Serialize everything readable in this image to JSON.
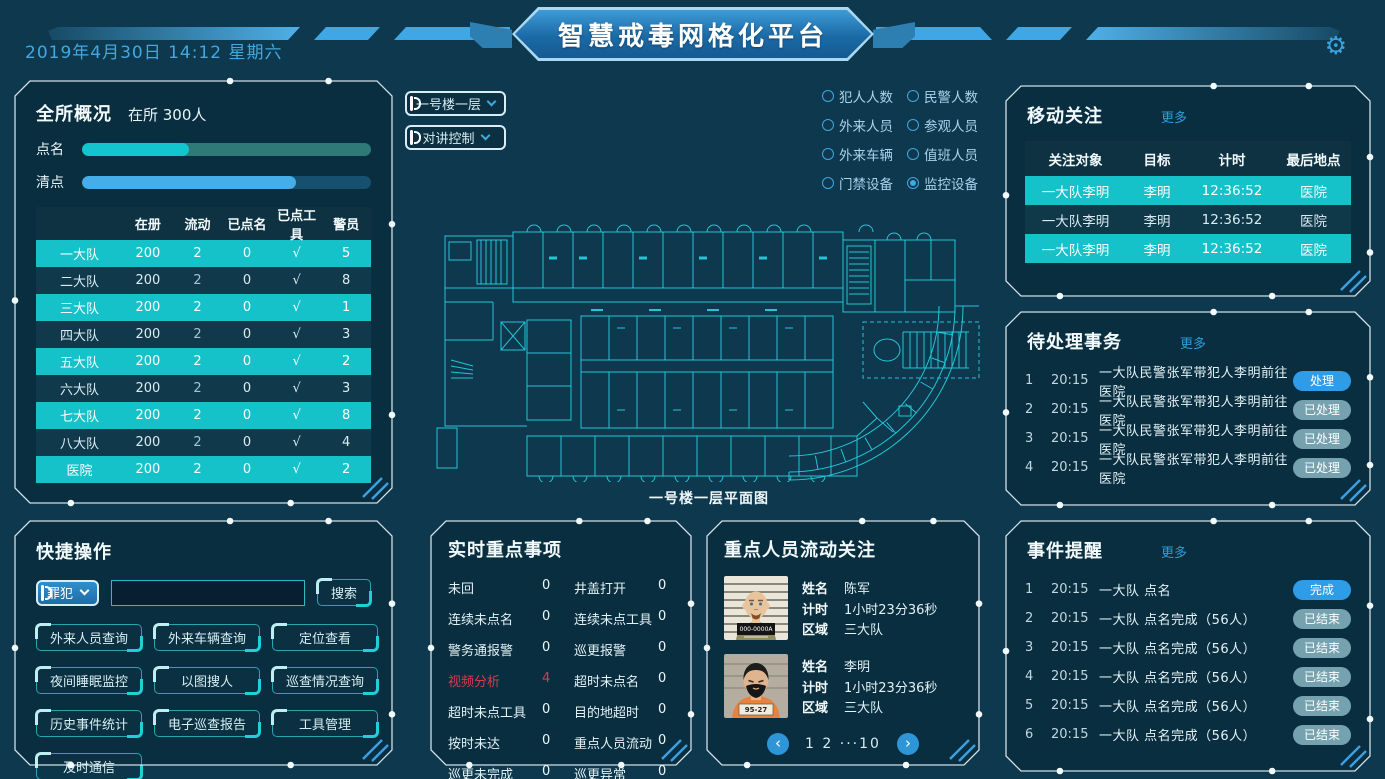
{
  "colors": {
    "background": "#0d384d",
    "panel": "#08283a",
    "accent_blue": "#2f9ce8",
    "accent_cyan": "#15c2ca",
    "row_dark": "#103a4c",
    "bar_rollcall_fill": "#12c5ce",
    "bar_rollcall_track": "#2e7a76",
    "bar_count_fill": "#45aee8",
    "bar_count_track": "#15516e",
    "muted_pill": "#92bfca",
    "alert_red": "#d93a50",
    "floorplan_line": "#23c6d6",
    "link_blue": "#2f9ddb"
  },
  "header": {
    "datetime": "2019年4月30日  14:12  星期六",
    "title": "智慧戒毒网格化平台",
    "settings_icon": "gear-icon",
    "gear_glyph": "⚙"
  },
  "overview": {
    "title": "全所概况",
    "occupancy_label": "在所 300人",
    "bars": [
      {
        "label": "点名",
        "percent": 37
      },
      {
        "label": "清点",
        "percent": 74
      }
    ],
    "table": {
      "headers": [
        "",
        "在册",
        "流动",
        "已点名",
        "已点工具",
        "警员"
      ],
      "rows": [
        {
          "name": "一大队",
          "values": [
            "200",
            "2",
            "0",
            "√",
            "5"
          ],
          "highlight": true
        },
        {
          "name": "二大队",
          "values": [
            "200",
            "2",
            "0",
            "√",
            "8"
          ],
          "highlight": false
        },
        {
          "name": "三大队",
          "values": [
            "200",
            "2",
            "0",
            "√",
            "1"
          ],
          "highlight": true
        },
        {
          "name": "四大队",
          "values": [
            "200",
            "2",
            "0",
            "√",
            "3"
          ],
          "highlight": false
        },
        {
          "name": "五大队",
          "values": [
            "200",
            "2",
            "0",
            "√",
            "2"
          ],
          "highlight": true
        },
        {
          "name": "六大队",
          "values": [
            "200",
            "2",
            "0",
            "√",
            "3"
          ],
          "highlight": false
        },
        {
          "name": "七大队",
          "values": [
            "200",
            "2",
            "0",
            "√",
            "8"
          ],
          "highlight": true
        },
        {
          "name": "八大队",
          "values": [
            "200",
            "2",
            "0",
            "√",
            "4"
          ],
          "highlight": false
        },
        {
          "name": "医院",
          "values": [
            "200",
            "2",
            "0",
            "√",
            "2"
          ],
          "highlight": true
        }
      ]
    }
  },
  "map": {
    "dropdowns": [
      "一号楼一层",
      "对讲控制"
    ],
    "radios": [
      {
        "label": "犯人人数",
        "checked": false
      },
      {
        "label": "民警人数",
        "checked": false
      },
      {
        "label": "外来人员",
        "checked": false
      },
      {
        "label": "参观人员",
        "checked": false
      },
      {
        "label": "外来车辆",
        "checked": false
      },
      {
        "label": "值班人员",
        "checked": false
      },
      {
        "label": "门禁设备",
        "checked": false
      },
      {
        "label": "监控设备",
        "checked": true
      }
    ],
    "caption": "一号楼一层平面图"
  },
  "mobile_focus": {
    "title": "移动关注",
    "more": "更多",
    "headers": [
      "关注对象",
      "目标",
      "计时",
      "最后地点"
    ],
    "rows": [
      {
        "target": "一大队李明",
        "person": "李明",
        "time": "12:36:52",
        "location": "医院"
      },
      {
        "target": "一大队李明",
        "person": "李明",
        "time": "12:36:52",
        "location": "医院"
      },
      {
        "target": "一大队李明",
        "person": "李明",
        "time": "12:36:52",
        "location": "医院"
      }
    ]
  },
  "pending": {
    "title": "待处理事务",
    "more": "更多",
    "rows": [
      {
        "no": "1",
        "time": "20:15",
        "text": "一大队民警张军带犯人李明前往医院",
        "action": "处理",
        "state": "primary"
      },
      {
        "no": "2",
        "time": "20:15",
        "text": "一大队民警张军带犯人李明前往医院",
        "action": "已处理",
        "state": "muted"
      },
      {
        "no": "3",
        "time": "20:15",
        "text": "一大队民警张军带犯人李明前往医院",
        "action": "已处理",
        "state": "muted"
      },
      {
        "no": "4",
        "time": "20:15",
        "text": "一大队民警张军带犯人李明前往医院",
        "action": "已处理",
        "state": "muted"
      }
    ]
  },
  "quick": {
    "title": "快捷操作",
    "select_value": "罪犯",
    "search": {
      "value": "",
      "placeholder": ""
    },
    "search_button": "搜索",
    "buttons": [
      "外来人员查询",
      "外来车辆查询",
      "定位查看",
      "夜间睡眠监控",
      "以图搜人",
      "巡查情况查询",
      "历史事件统计",
      "电子巡查报告",
      "工具管理",
      "及时通信"
    ]
  },
  "realtime": {
    "title": "实时重点事项",
    "stats": [
      {
        "label": "未回",
        "value": "0",
        "alert": false
      },
      {
        "label": "井盖打开",
        "value": "0",
        "alert": false
      },
      {
        "label": "连续未点名",
        "value": "0",
        "alert": false
      },
      {
        "label": "连续未点工具",
        "value": "0",
        "alert": false
      },
      {
        "label": "警务通报警",
        "value": "0",
        "alert": false
      },
      {
        "label": "巡更报警",
        "value": "0",
        "alert": false
      },
      {
        "label": "视频分析",
        "value": "4",
        "alert": true
      },
      {
        "label": "超时未点名",
        "value": "0",
        "alert": false
      },
      {
        "label": "超时未点工具",
        "value": "0",
        "alert": false
      },
      {
        "label": "目的地超时",
        "value": "0",
        "alert": false
      },
      {
        "label": "按时未达",
        "value": "0",
        "alert": false
      },
      {
        "label": "重点人员流动",
        "value": "0",
        "alert": false
      },
      {
        "label": "巡更未完成",
        "value": "0",
        "alert": false
      },
      {
        "label": "巡更异常",
        "value": "0",
        "alert": false
      }
    ]
  },
  "persons": {
    "title": "重点人员流动关注",
    "name_label": "姓名",
    "time_label": "计时",
    "area_label": "区域",
    "cards": [
      {
        "name": "陈军",
        "time": "1小时23分36秒",
        "area": "三大队",
        "placard": "000-0000A"
      },
      {
        "name": "李明",
        "time": "1小时23分36秒",
        "area": "三大队",
        "placard": "95-27"
      }
    ],
    "pagination": {
      "prev": "‹",
      "pages": "1 2 ···10",
      "next": "›"
    }
  },
  "events": {
    "title": "事件提醒",
    "more": "更多",
    "rows": [
      {
        "no": "1",
        "time": "20:15",
        "text": "一大队 点名",
        "action": "完成",
        "state": "primary"
      },
      {
        "no": "2",
        "time": "20:15",
        "text": "一大队 点名完成（56人）",
        "action": "已结束",
        "state": "muted"
      },
      {
        "no": "3",
        "time": "20:15",
        "text": "一大队 点名完成（56人）",
        "action": "已结束",
        "state": "muted"
      },
      {
        "no": "4",
        "time": "20:15",
        "text": "一大队 点名完成（56人）",
        "action": "已结束",
        "state": "muted"
      },
      {
        "no": "5",
        "time": "20:15",
        "text": "一大队 点名完成（56人）",
        "action": "已结束",
        "state": "muted"
      },
      {
        "no": "6",
        "time": "20:15",
        "text": "一大队 点名完成（56人）",
        "action": "已结束",
        "state": "muted"
      }
    ]
  }
}
